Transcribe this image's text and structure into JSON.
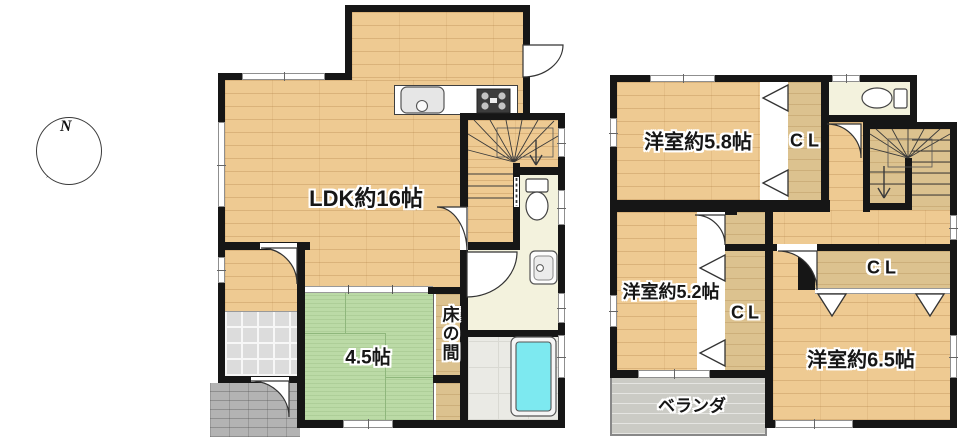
{
  "compass": {
    "north": "N"
  },
  "floor1": {
    "ldk": "LDK約16帖",
    "tatami": "4.5帖",
    "tokonoma": "床の間"
  },
  "floor2": {
    "room58": "洋室約5.8帖",
    "cl58": "CL",
    "room52": "洋室約5.2帖",
    "cl52": "CL",
    "room65": "洋室約6.5帖",
    "cl65": "CL",
    "veranda": "ベランダ"
  },
  "colors": {
    "wall": "#161616",
    "wood_floor": "#eeca92",
    "tatami_green": "#bbdaa6",
    "closet_wood": "#dcc28f",
    "room_cream": "#f3f2dd",
    "bathtub_cyan": "#7de9f0",
    "bath_tile": "#eaeae5",
    "genkan_tile": "#dcdcdc",
    "porch_gray": "#b3b3b3",
    "veranda_gray": "#cbcbc5"
  }
}
